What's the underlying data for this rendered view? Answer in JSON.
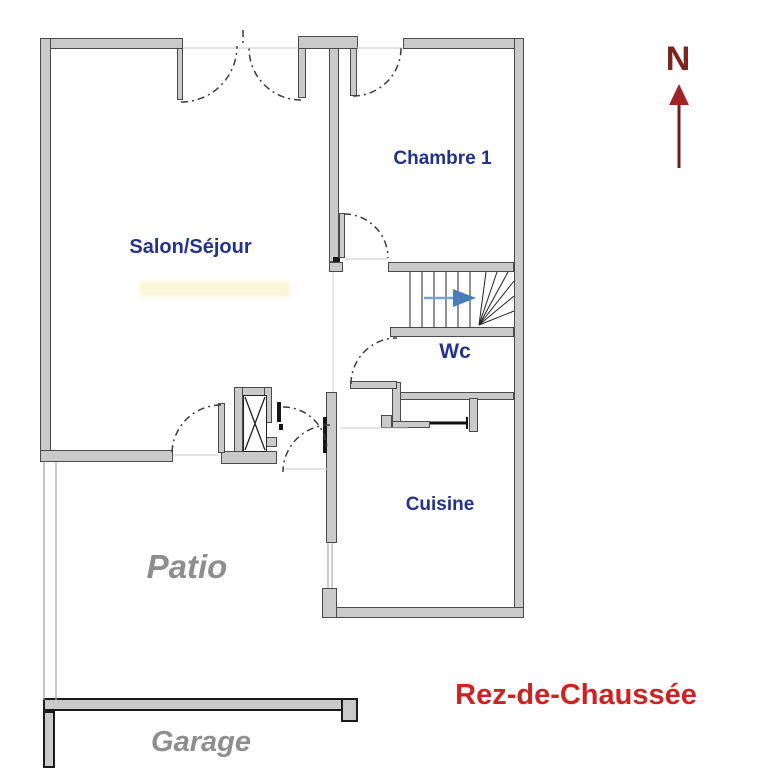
{
  "floor_plan": {
    "title": "Rez-de-Chaussée",
    "north_label": "N",
    "rooms": {
      "salon": {
        "label": "Salon/Séjour"
      },
      "chambre1": {
        "label": "Chambre 1"
      },
      "wc": {
        "label": "Wc"
      },
      "cuisine": {
        "label": "Cuisine"
      },
      "patio": {
        "label": "Patio"
      },
      "garage": {
        "label": "Garage"
      }
    }
  },
  "icons": {
    "north_arrow": "up-arrow",
    "stair_direction": "right-arrow"
  },
  "colors": {
    "room_label": "#24328a",
    "outdoor_label": "#8e8e8e",
    "title_red": "#cc2424",
    "north_red": "#7b2424",
    "north_arrow": "#6b1d1d",
    "north_arrow_head": "#a02424",
    "wall_fill": "#cacaca",
    "wall_outline": "#4a4a4a",
    "stair_arrow": "#4a7cba",
    "stair_arrow_light": "#7ba3cf",
    "arc_line": "#3c3c3c"
  }
}
